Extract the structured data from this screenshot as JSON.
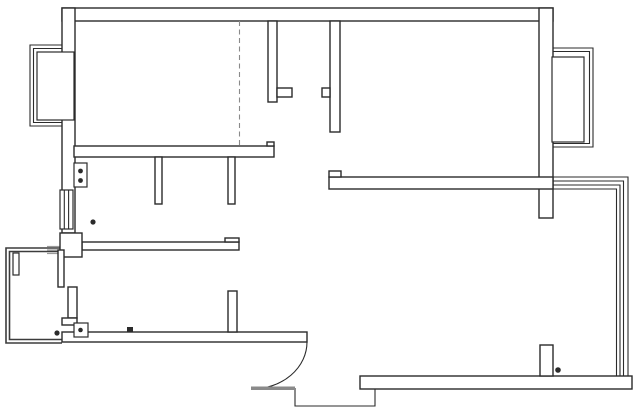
{
  "canvas": {
    "width": 640,
    "height": 414,
    "background": "#ffffff",
    "ink_color": "#2b2b2b",
    "balcony_color": "#3c3c3c",
    "gray_color": "#9a9a9a",
    "dash_color": "#8a8a8a"
  },
  "floorplan": {
    "gray_lines": [
      {
        "name": "pier-balcony-join-1",
        "x1": 47,
        "y1": 246.5,
        "x2": 62,
        "y2": 246.5
      },
      {
        "name": "pier-balcony-join-2",
        "x1": 47,
        "y1": 250,
        "x2": 62,
        "y2": 250
      },
      {
        "name": "pier-balcony-join-3",
        "x1": 47,
        "y1": 253.5,
        "x2": 62,
        "y2": 253.5
      }
    ],
    "balcony_paths": [
      {
        "name": "balcony-outer-wall",
        "d": "M62,248 H6 V343 H62"
      },
      {
        "name": "balcony-inner-wall",
        "d": "M62,251.5 H9.5 V339.5 H62"
      }
    ],
    "frame_paths": [
      {
        "name": "left-bay-frame-outer",
        "d": "M75,45 H30 V126 H75"
      },
      {
        "name": "left-bay-frame-inner",
        "d": "M75,48.5 H33.5 V122.5 H75"
      },
      {
        "name": "right-bay-frame-outer",
        "d": "M553,48 H593 V147 H553"
      },
      {
        "name": "right-bay-frame-inner",
        "d": "M553,51.5 H589.5 V143.5 H553"
      }
    ],
    "glazing_paths": [
      {
        "name": "sunroom-glazing-line-1",
        "d": "M553,177 H628 V376"
      },
      {
        "name": "sunroom-glazing-line-2",
        "d": "M553,181 H623.5 V376"
      },
      {
        "name": "sunroom-glazing-line-3",
        "d": "M553,185 H620 V376"
      },
      {
        "name": "sunroom-glazing-line-4",
        "d": "M553,189 H616.5 V376"
      }
    ],
    "wall_rects": [
      {
        "name": "top-wall",
        "x": 62,
        "y": 8,
        "w": 491,
        "h": 13
      },
      {
        "name": "left-wall",
        "x": 62,
        "y": 8,
        "w": 13,
        "h": 225
      },
      {
        "name": "right-wall",
        "x": 539,
        "y": 8,
        "w": 14,
        "h": 210
      },
      {
        "name": "bedroom1-bottom-wall",
        "x": 74,
        "y": 146,
        "w": 200,
        "h": 11
      },
      {
        "name": "bedroom1-bottom-wall-tab",
        "x": 267,
        "y": 142,
        "w": 7,
        "h": 4
      },
      {
        "name": "bedroom1-right-wall",
        "x": 268,
        "y": 21,
        "w": 9,
        "h": 81
      },
      {
        "name": "bedroom1-right-wall-foot",
        "x": 277,
        "y": 88,
        "w": 15,
        "h": 9
      },
      {
        "name": "bedroom2-left-wall",
        "x": 330,
        "y": 21,
        "w": 10,
        "h": 111
      },
      {
        "name": "bedroom2-left-wall-notch",
        "x": 322,
        "y": 88,
        "w": 8,
        "h": 9
      },
      {
        "name": "bedroom2-bottom-wall",
        "x": 329,
        "y": 177,
        "w": 224,
        "h": 12
      },
      {
        "name": "bedroom2-bottom-wall-tab",
        "x": 329,
        "y": 171,
        "w": 12,
        "h": 6
      },
      {
        "name": "kitchen-stub-left",
        "x": 155,
        "y": 157,
        "w": 7,
        "h": 47
      },
      {
        "name": "kitchen-stub-right",
        "x": 228,
        "y": 157,
        "w": 7,
        "h": 47
      },
      {
        "name": "kitchen-bottom-wall",
        "x": 82,
        "y": 242,
        "w": 157,
        "h": 8
      },
      {
        "name": "kitchen-bottom-wall-tab",
        "x": 225,
        "y": 238,
        "w": 14,
        "h": 4
      },
      {
        "name": "left-pier",
        "x": 60,
        "y": 233,
        "w": 22,
        "h": 24
      },
      {
        "name": "balcony-edge-bar",
        "x": 58,
        "y": 250,
        "w": 6,
        "h": 37
      },
      {
        "name": "hall-stub",
        "x": 68,
        "y": 287,
        "w": 9,
        "h": 31
      },
      {
        "name": "hall-stub-foot",
        "x": 62,
        "y": 318,
        "w": 15,
        "h": 7
      },
      {
        "name": "living-bottom-wall",
        "x": 62,
        "y": 332,
        "w": 245,
        "h": 10
      },
      {
        "name": "living-stub",
        "x": 228,
        "y": 291,
        "w": 9,
        "h": 41
      },
      {
        "name": "entry-bottom-wall",
        "x": 360,
        "y": 376,
        "w": 272,
        "h": 13
      },
      {
        "name": "entry-stub",
        "x": 540,
        "y": 345,
        "w": 13,
        "h": 31
      }
    ],
    "window_panes": [
      {
        "name": "left-bay-window-pane",
        "x": 37,
        "y": 52,
        "w": 37,
        "h": 68
      },
      {
        "name": "kitchen-window",
        "x": 60,
        "y": 190,
        "w": 13,
        "h": 39
      },
      {
        "name": "right-bay-window-pane",
        "x": 552,
        "y": 57,
        "w": 32,
        "h": 85
      }
    ],
    "detail_paths": [
      {
        "name": "kitchen-window-mullion-1",
        "d": "M64.3,190 V229"
      },
      {
        "name": "kitchen-window-mullion-2",
        "d": "M68.6,190 V229"
      },
      {
        "name": "entry-porch-step",
        "d": "M295,388 V406 H375 V389"
      },
      {
        "name": "entry-door-arc",
        "d": "M307,342 A55,47 0 0 1 252,389"
      }
    ],
    "dashed_lines": [
      {
        "name": "wardrobe-dashed-line",
        "x1": 239.5,
        "y1": 21,
        "x2": 239.5,
        "y2": 146
      }
    ],
    "gray_fill_rects": [
      {
        "name": "entry-door-threshold",
        "x": 251,
        "y": 386.5,
        "w": 44,
        "h": 3.5
      }
    ],
    "symbol_boxes": [
      {
        "name": "stove-symbol-box",
        "x": 74,
        "y": 163,
        "w": 13,
        "h": 24
      },
      {
        "name": "outlet-symbol-box",
        "x": 74,
        "y": 323,
        "w": 14,
        "h": 14
      },
      {
        "name": "balcony-pillar",
        "x": 13,
        "y": 253,
        "w": 6,
        "h": 22
      }
    ],
    "filled_rects": [
      {
        "name": "floor-drain-square",
        "x": 127,
        "y": 327,
        "w": 6,
        "h": 5.5
      }
    ],
    "dots": [
      {
        "name": "stove-burner-dot-top",
        "cx": 80.5,
        "cy": 171,
        "r": 2.4
      },
      {
        "name": "stove-burner-dot-bottom",
        "cx": 80.5,
        "cy": 180.5,
        "r": 2.4
      },
      {
        "name": "kitchen-floor-dot",
        "cx": 93,
        "cy": 222,
        "r": 2.6
      },
      {
        "name": "outlet-dot",
        "cx": 80.5,
        "cy": 330,
        "r": 2.3
      },
      {
        "name": "balcony-corner-dot",
        "cx": 57,
        "cy": 333,
        "r": 2.6
      },
      {
        "name": "entry-wall-dot",
        "cx": 558,
        "cy": 370,
        "r": 2.8
      }
    ]
  }
}
